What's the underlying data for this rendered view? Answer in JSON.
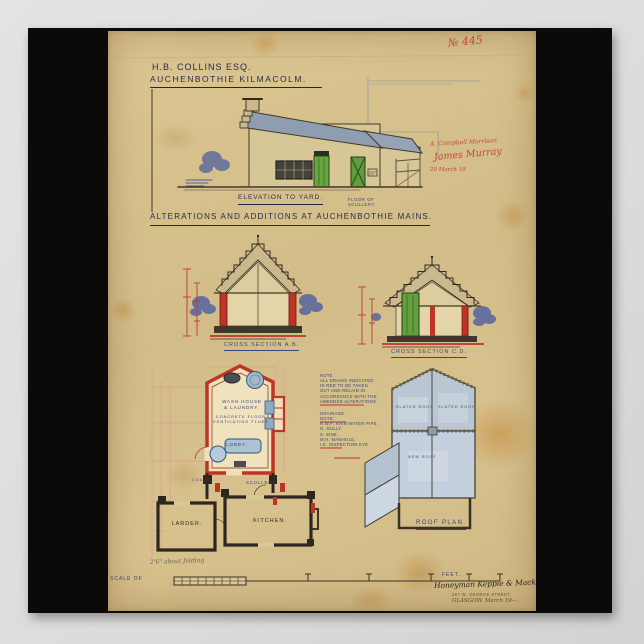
{
  "poster": {
    "drawing_no": "№ 445",
    "client": {
      "line1": "H.B. COLLINS ESQ.",
      "line2": "AUCHENBOTHIE  KILMACOLM."
    },
    "title": "ALTERATIONS  AND  ADDITIONS  AT  AUCHENBOTHIE  MAINS.",
    "red_annotations": {
      "line1": "A. Campbell Morrison",
      "line2": "James Murray",
      "line3": "20 March 19"
    },
    "elevation": {
      "caption": "ELEVATION  TO  YARD.",
      "sub_caption": "FLOOR OF\nSCULLERY."
    },
    "sections": {
      "left_caption": "CROSS  SECTION  A.B.",
      "right_caption": "CROSS  SECTION  C.D."
    },
    "notes": {
      "note1": "NOTE.\nALL DRAINS INDICATED\nIN RED TO BE TAKEN\nOUT AND RELAID IN\nACCORDANCE WITH THE\nAMENDED ALTERATIONS.",
      "note2": "DRAINAGE.\nNOTE:\nR.W.P.  RAIN WATER PIPE.\nG.  GULLY.\nS.  SINK.\nM.H.  MANHOLE.\nI.E.  INSPECTION EYE."
    },
    "plan": {
      "rooms": {
        "wash_house": "WASH HOUSE\n& LAUNDRY.",
        "concrete": "CONCRETE FLOOR.\nVENTILATING FLUES.",
        "lobby": "LOBBY.",
        "scullery": "SCULLERY.",
        "coals": "COALS.",
        "larder": "LARDER.",
        "kitchen": "KITCHEN."
      },
      "pencil_note": "2'6\" about folding"
    },
    "roof_plan": {
      "caption": "ROOF  PLAN.",
      "labels": [
        "SLATED ROOF",
        "SLATED ROOF",
        "NEW ROOF"
      ]
    },
    "scale": {
      "label": "SCALE OF",
      "unit": "FEET."
    },
    "signature": {
      "firm": "Honeyman Keppie & Mackintosh",
      "address": "257 W. GEORGE STREET.",
      "city_date": "GLASGOW.  March 19—."
    }
  },
  "colors": {
    "paper": "#d5bf8c",
    "ink": "#2a2c49",
    "new_work_red": "#bf3426",
    "roof_wash_blue": "#8f9db1",
    "door_green": "#68a441",
    "annotation_blue": "#3b4577",
    "annotation_red": "#c24534",
    "black_mount": "#0b0a09"
  }
}
